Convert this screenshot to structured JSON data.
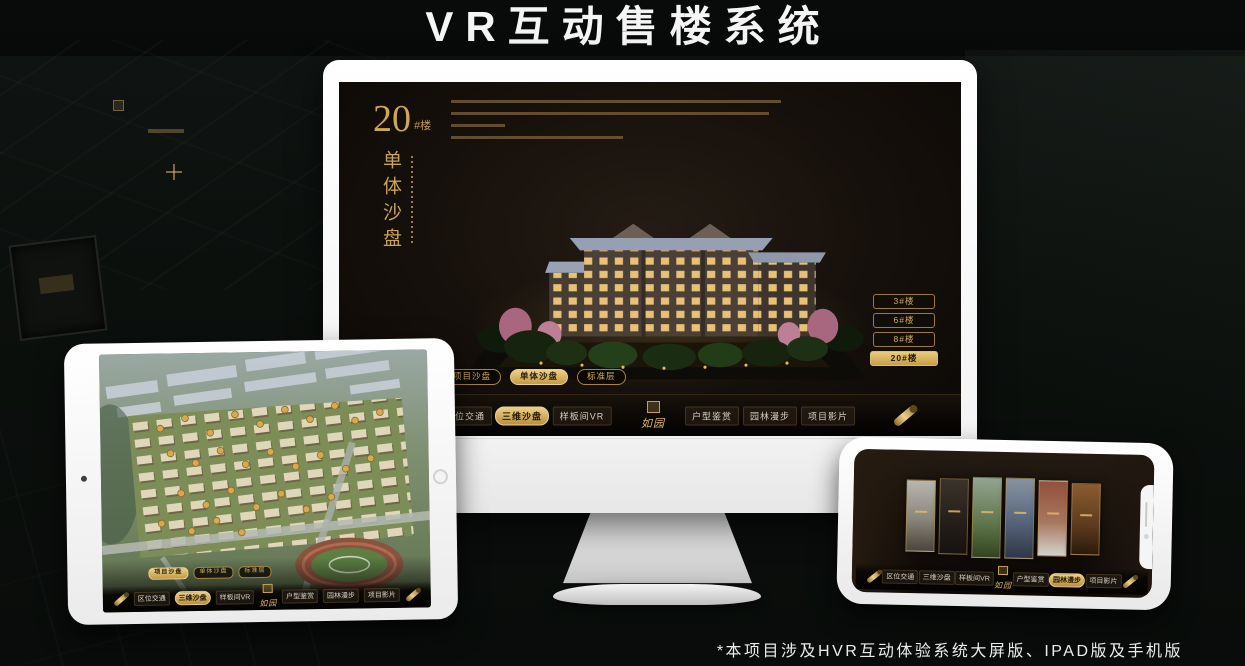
{
  "page": {
    "title": "VR互动售楼系统",
    "footnote": "*本项目涉及HVR互动体验系统大屏版、IPAD版及手机版"
  },
  "brand": {
    "name": "如园"
  },
  "colors": {
    "gold": "#c9a24f",
    "gold_light": "#ecd088",
    "page_background": "#0c100d",
    "screen_background": "#17110c",
    "title_text": "#f5f5f5"
  },
  "monitor_ui": {
    "floor_label": {
      "number": "20",
      "suffix": "#楼"
    },
    "section_title_vertical": "单体沙盘",
    "floor_buttons": [
      {
        "label": "3#楼",
        "active": false
      },
      {
        "label": "6#楼",
        "active": false
      },
      {
        "label": "8#楼",
        "active": false
      },
      {
        "label": "20#楼",
        "active": true
      }
    ],
    "mode_tabs": [
      {
        "label": "项目沙盘",
        "active": false
      },
      {
        "label": "单体沙盘",
        "active": true
      },
      {
        "label": "标准层",
        "active": false
      }
    ],
    "nav_items": [
      {
        "label": "区位交通",
        "active": false
      },
      {
        "label": "三维沙盘",
        "active": true
      },
      {
        "label": "样板间VR",
        "active": false
      },
      {
        "label": "户型鉴赏",
        "active": false
      },
      {
        "label": "园林漫步",
        "active": false
      },
      {
        "label": "项目影片",
        "active": false
      }
    ]
  },
  "tablet_ui": {
    "mode_tabs": [
      {
        "label": "项目沙盘",
        "active": true
      },
      {
        "label": "单体沙盘",
        "active": false
      },
      {
        "label": "标准层",
        "active": false
      }
    ],
    "nav_items": [
      {
        "label": "区位交通",
        "active": false
      },
      {
        "label": "三维沙盘",
        "active": true
      },
      {
        "label": "样板间VR",
        "active": false
      },
      {
        "label": "户型鉴赏",
        "active": false
      },
      {
        "label": "园林漫步",
        "active": false
      },
      {
        "label": "项目影片",
        "active": false
      }
    ]
  },
  "phone_ui": {
    "nav_items": [
      {
        "label": "区位交通",
        "active": false
      },
      {
        "label": "三维沙盘",
        "active": false
      },
      {
        "label": "样板间VR",
        "active": false
      },
      {
        "label": "户型鉴赏",
        "active": false
      },
      {
        "label": "园林漫步",
        "active": true
      },
      {
        "label": "项目影片",
        "active": false
      }
    ]
  }
}
